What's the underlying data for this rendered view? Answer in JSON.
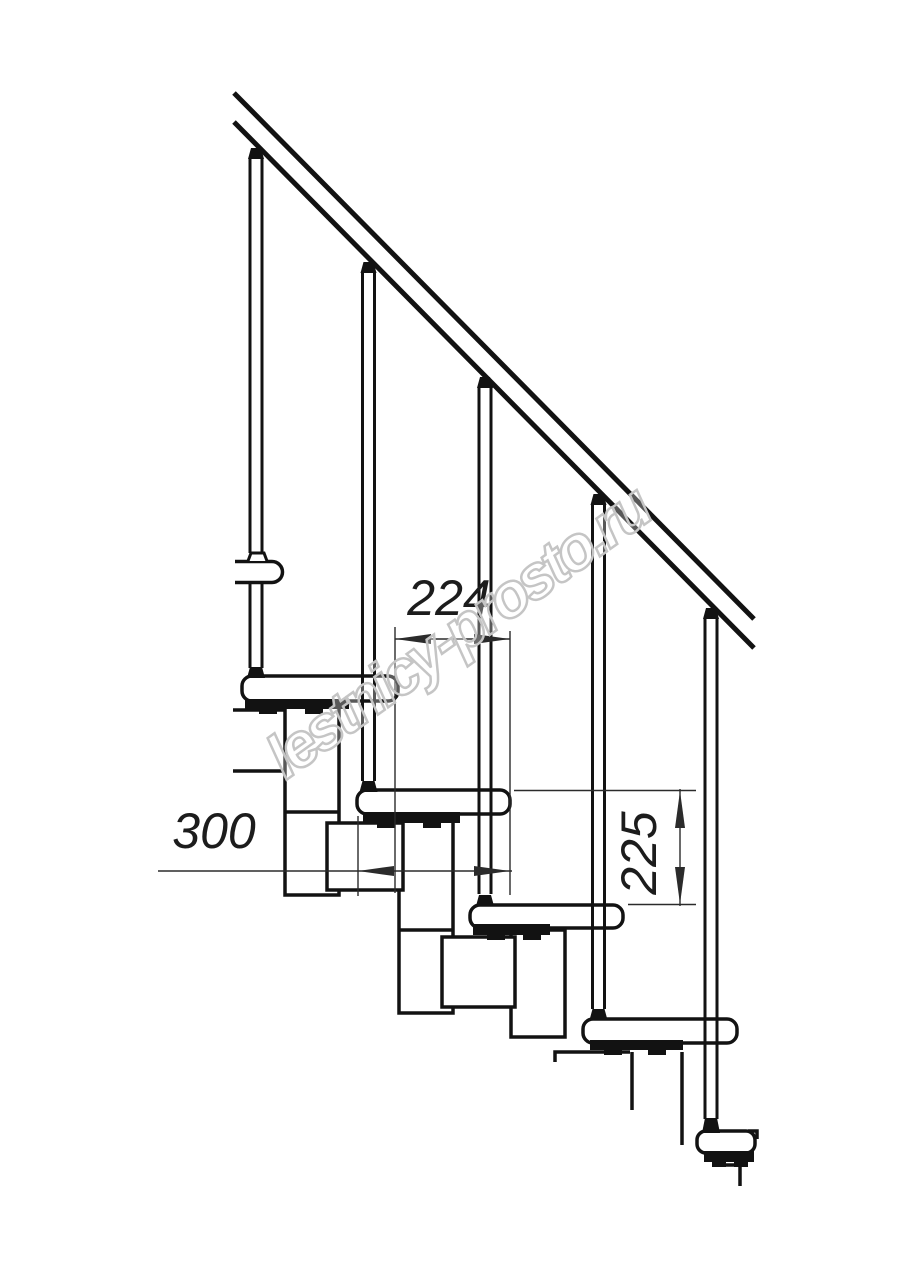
{
  "drawing": {
    "dimension_labels": {
      "tread_run_mm": "224",
      "tread_depth_mm": "300",
      "step_rise_mm": "225"
    },
    "watermark_text": "lestnicy-prosto.ru",
    "colors": {
      "line": "#121212",
      "dimension": "#2b2b2b",
      "watermark": "#c5c5c5",
      "background": "#ffffff"
    }
  }
}
